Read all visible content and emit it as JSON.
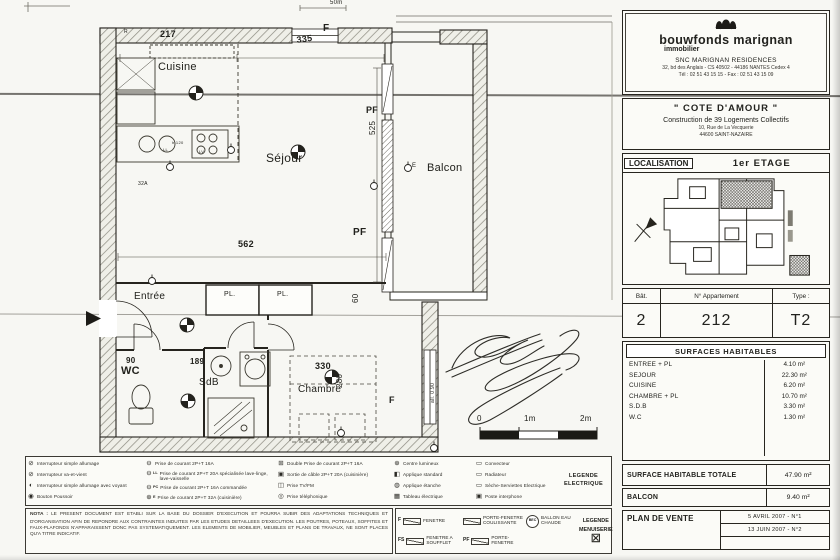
{
  "colors": {
    "paper": "#f7f7f3",
    "ink": "#22221e"
  },
  "plan": {
    "labels": [
      {
        "t": "Cuisine",
        "x": 158,
        "y": 62,
        "s": 11
      },
      {
        "t": "Séjour",
        "x": 266,
        "y": 152,
        "s": 12
      },
      {
        "t": "Balcon",
        "x": 427,
        "y": 163,
        "s": 11
      },
      {
        "t": "Entrée",
        "x": 134,
        "y": 292,
        "s": 10
      },
      {
        "t": "WC",
        "x": 121,
        "y": 366,
        "s": 11,
        "b": 1
      },
      {
        "t": "SdB",
        "x": 199,
        "y": 378,
        "s": 10
      },
      {
        "t": "Chambre",
        "x": 298,
        "y": 385,
        "s": 10
      },
      {
        "t": "PL.",
        "x": 224,
        "y": 291,
        "s": 7
      },
      {
        "t": "PL.",
        "x": 277,
        "y": 291,
        "s": 7
      },
      {
        "t": "217",
        "x": 160,
        "y": 30,
        "s": 9,
        "b": 1
      },
      {
        "t": "335",
        "x": 296,
        "y": 36,
        "s": 9,
        "b": 1,
        "r": -8
      },
      {
        "t": "50m",
        "x": 330,
        "y": 0,
        "s": 6
      },
      {
        "t": "525",
        "x": 369,
        "y": 135,
        "s": 8,
        "r": -90
      },
      {
        "t": "562",
        "x": 238,
        "y": 240,
        "s": 9,
        "b": 1
      },
      {
        "t": "60",
        "x": 352,
        "y": 303,
        "s": 8,
        "r": -90
      },
      {
        "t": "90",
        "x": 126,
        "y": 357,
        "s": 8,
        "b": 1
      },
      {
        "t": "189",
        "x": 190,
        "y": 358,
        "s": 8,
        "b": 1
      },
      {
        "t": "330",
        "x": 315,
        "y": 362,
        "s": 9,
        "b": 1
      },
      {
        "t": "280",
        "x": 336,
        "y": 388,
        "s": 8,
        "r": -90
      },
      {
        "t": "all. 0.90",
        "x": 431,
        "y": 403,
        "s": 5,
        "r": -90
      },
      {
        "t": "F",
        "x": 323,
        "y": 24,
        "s": 10,
        "b": 1
      },
      {
        "t": "PF",
        "x": 366,
        "y": 106,
        "s": 9,
        "b": 1
      },
      {
        "t": "PF",
        "x": 353,
        "y": 228,
        "s": 10,
        "b": 1
      },
      {
        "t": "F",
        "x": 389,
        "y": 396,
        "s": 9,
        "b": 1
      },
      {
        "t": "E",
        "x": 412,
        "y": 163,
        "s": 6
      },
      {
        "t": "LL",
        "x": 163,
        "y": 148,
        "s": 4
      },
      {
        "t": "LV",
        "x": 199,
        "y": 150,
        "s": 4
      },
      {
        "t": "h.120",
        "x": 172,
        "y": 141,
        "s": 4
      },
      {
        "t": "32A",
        "x": 138,
        "y": 182,
        "s": 5
      },
      {
        "t": "R",
        "x": 124,
        "y": 30,
        "s": 5
      },
      {
        "t": "0",
        "x": 477,
        "y": 415,
        "s": 8
      },
      {
        "t": "1m",
        "x": 524,
        "y": 415,
        "s": 8
      },
      {
        "t": "2m",
        "x": 580,
        "y": 415,
        "s": 8
      }
    ]
  },
  "legend_electrique": {
    "title": "LEGENDE ELECTRIQUE",
    "columns": [
      {
        "items": [
          {
            "sym": "interrupteur-simple",
            "label": "Interrupteur simple allumage"
          },
          {
            "sym": "interrupteur-va-et-vient",
            "label": "Interrupteur va-et-vient"
          },
          {
            "sym": "interrupteur-voyant",
            "label": "Interrupteur simple allumage avec voyant"
          },
          {
            "sym": "bouton-poussoir",
            "label": "Bouton Poussoir"
          }
        ]
      },
      {
        "items": [
          {
            "sym": "prise-16a",
            "label": "Prise de courant 2P+T 16A"
          },
          {
            "sym": "prise-20a",
            "tag": "LL",
            "label": "Prise de courant 2P+T 20A spécialisée lave-linge, lave-vaisselle"
          },
          {
            "sym": "prise-16a-commandee",
            "tag": "PC",
            "label": "Prise de courant 2P+T 16A commandée"
          },
          {
            "sym": "prise-32a",
            "tag": "E",
            "label": "Prise de courant 2P+T 32A (cuisinière)"
          }
        ]
      },
      {
        "items": [
          {
            "sym": "double-prise-16a",
            "label": "Double Prise de courant 2P+T 16A"
          },
          {
            "sym": "sortie-cable",
            "label": "Sortie de câble 2P+T 20A (cuisinière)"
          },
          {
            "sym": "prise-tv-fm",
            "label": "Prise TV/FM"
          },
          {
            "sym": "prise-telephonique",
            "label": "Prise téléphonique"
          }
        ]
      },
      {
        "items": [
          {
            "sym": "centre-lumineux",
            "label": "Centre lumineux"
          },
          {
            "sym": "applique-standard",
            "label": "Applique standard"
          },
          {
            "sym": "applique-etanche",
            "label": "Applique étanche"
          },
          {
            "sym": "tableau-electrique",
            "label": "Tableau électrique"
          }
        ]
      },
      {
        "items": [
          {
            "sym": "convecteur",
            "label": "Convecteur"
          },
          {
            "sym": "radiateur",
            "label": "Radiateur"
          },
          {
            "sym": "seche-serviettes",
            "label": "Sèche-Serviettes Electrique"
          },
          {
            "sym": "poste-interphone",
            "label": "Poste interphone"
          }
        ]
      }
    ]
  },
  "nota": {
    "label": "NOTA :",
    "text": "LE PRESENT DOCUMENT EST ETABLI SUR LA BASE DU DOSSIER D'EXECUTION ET POURRA SUBIR DES ADAPTATIONS TECHNIQUES ET D'ORGANISATION AFIN DE REPONDRE AUX CONTRAINTES INDUITES PAR LES ETUDES DETAILLEES D'EXECUTION. LES POUTRES, POTEAUX, SOFFITES ET FAUX-PLAFONDS N'APPARAISSENT DONC PAS SYSTEMATIQUEMENT. LES ELEMENTS DE MOBILIER, MEUBLES ET PLANS DE TRAVAUX, NE SONT PLACES QU'A TITRE INDICATIF."
  },
  "legend_menuiserie": {
    "title": "LEGENDE MENUISERIE",
    "cells": [
      {
        "tag": "F",
        "label": "FENETRE"
      },
      {
        "tag": "",
        "label": "PORTE-FENETRE COULISSANTE"
      },
      {
        "tag": "BEC",
        "label": "BALLON EAU CHAUDE",
        "round": true
      },
      {
        "tag": "FS",
        "label": "FENETRE A SOUFFLET"
      },
      {
        "tag": "PF",
        "label": "PORTE-FENETRE"
      }
    ]
  },
  "title_block": {
    "logo": {
      "brand": "bouwfonds marignan",
      "sub": "immobilier",
      "company": "SNC MARIGNAN RESIDENCES",
      "address": "32, bd des Anglais - CS 40502 - 44186 NANTES Cedex 4",
      "telfax": "Tél : 02 51 43 15 15 - Fax : 02 51 43 15 09"
    },
    "project": {
      "name": "\" COTE  D'AMOUR \"",
      "desc": "Construction de 39 Logements Collectifs",
      "addr1": "10, Rue de La Vecquerie",
      "addr2": "44600  SAINT-NAZAIRE"
    },
    "localisation": {
      "label": "LOCALISATION",
      "value": "1er ETAGE"
    },
    "unit": {
      "bat_label": "Bât.",
      "bat": "2",
      "apt_label": "N° Appartement",
      "apt": "212",
      "type_label": "Type :",
      "type": "T2"
    },
    "surfaces": {
      "title": "SURFACES HABITABLES",
      "rows": [
        {
          "label": "ENTREE + PL",
          "value": "4.10 m²"
        },
        {
          "label": "SEJOUR",
          "value": "22.30 m²"
        },
        {
          "label": "CUISINE",
          "value": "6.20 m²"
        },
        {
          "label": "CHAMBRE + PL",
          "value": "10.70 m²"
        },
        {
          "label": "S.D.B",
          "value": "3.30 m²"
        },
        {
          "label": "W.C",
          "value": "1.30 m²"
        }
      ]
    },
    "totale": {
      "label": "SURFACE HABITABLE TOTALE",
      "value": "47.90 m²"
    },
    "balcon": {
      "label": "BALCON",
      "value": "9.40 m²"
    },
    "plan_de_vente": {
      "label": "PLAN DE VENTE",
      "revisions": [
        "5 AVRIL 2007  -  N°1",
        "13 JUIN 2007  -  N°2",
        ""
      ]
    }
  }
}
